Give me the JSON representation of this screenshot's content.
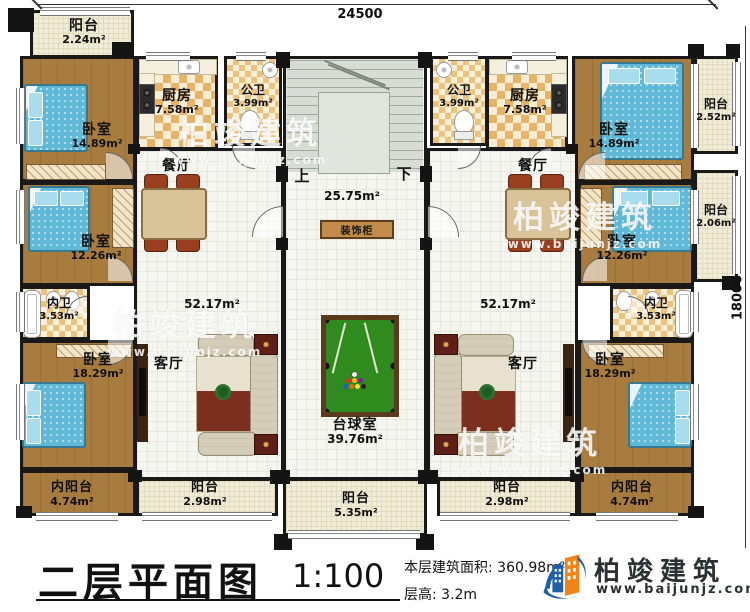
{
  "dimensions": {
    "top": "24500",
    "right": "18000"
  },
  "rooms": {
    "balcony_tl": {
      "label": "阳台",
      "area": "2.24m²"
    },
    "bedroom_t": {
      "label": "卧室",
      "area": "14.89m²"
    },
    "kitchen": {
      "label": "厨房",
      "area": "7.58m²"
    },
    "pub_bath": {
      "label": "公卫",
      "area": "3.99m²"
    },
    "balcony_tr": {
      "label": "阳台",
      "area": "2.52m²"
    },
    "dining": {
      "label": "餐厅"
    },
    "living": {
      "label": "客厅",
      "area": "52.17m²"
    },
    "bedroom_m": {
      "label": "卧室",
      "area": "12.26m²"
    },
    "balcony_mr": {
      "label": "阳台",
      "area": "2.06m²"
    },
    "inner_bath": {
      "label": "内卫",
      "area": "3.53m²"
    },
    "bedroom_b": {
      "label": "卧室",
      "area": "18.29m²"
    },
    "inner_balcony": {
      "label": "内阳台",
      "area": "4.74m²"
    },
    "balcony_side": {
      "label": "阳台",
      "area": "2.98m²"
    },
    "balcony_center": {
      "label": "阳台",
      "area": "5.35m²"
    },
    "billiard": {
      "label": "台球室",
      "area": "39.76m²"
    }
  },
  "hall": {
    "up": "上",
    "down": "下",
    "area": "25.75m²",
    "cabinet": "装饰柜"
  },
  "titleblock": {
    "title": "二层平面图",
    "scale": "1:100",
    "area_line": "本层建筑面积: 360.98m²",
    "height_line": "层高: 3.2m"
  },
  "logo": {
    "brand": "柏竣建筑",
    "url": "www.baijunjz.com"
  },
  "watermark": {
    "brand": "柏竣建筑",
    "url": "www.baijunjz.com"
  },
  "colors": {
    "wood": "#a87c3e",
    "tile": "#e7b366",
    "bed": "#5fb9d6",
    "pool_felt": "#2f8b1d",
    "wall": "#191919",
    "logo_blue": "#1f5fa8",
    "logo_orange": "#f08418"
  }
}
